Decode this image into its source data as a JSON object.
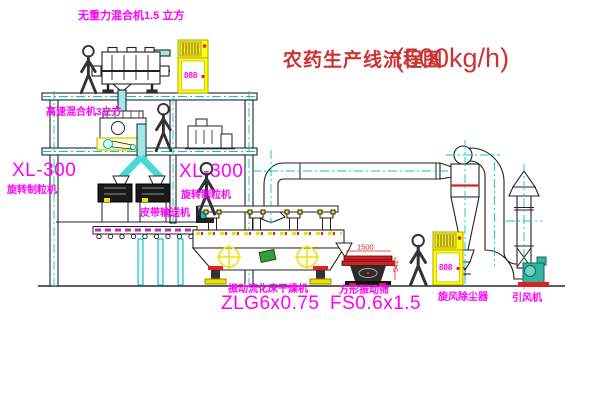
{
  "title": {
    "text": "农药生产线流程图",
    "capacity": "(500kg/h)"
  },
  "labels": {
    "gravity_mixer": "无重力混合机1.5 立方",
    "high_speed_mixer": "高速混合机3立方",
    "granulator_left": {
      "model": "XL-300",
      "name": "旋转制粒机"
    },
    "granulator_right": {
      "model": "XL-300",
      "name": "旋转制粒机"
    },
    "belt_conveyor": "皮带输送机",
    "dryer": {
      "name": "振动流化床干燥机",
      "model": "ZLG6x0.75"
    },
    "sieve": {
      "name": "方形振动筛",
      "model": "FS0.6x1.5"
    },
    "cyclone": "旋风除尘器",
    "fan": "引风机"
  },
  "dimensions": {
    "sieve_length": "1500",
    "sieve_height": "541"
  },
  "control_panel": {
    "display": "888"
  },
  "colors": {
    "label_magenta": "#ff00ff",
    "title_red": "#cc3333",
    "centerline_cyan": "#00c8c8",
    "pipe_cyan_fill": "#9fe8e8",
    "cabinet_yellow": "#ffff00",
    "accent_red": "#e02020",
    "port_yellow": "#f0e000",
    "fan_teal": "#2fb5a0",
    "machine_green": "#3a9a3a"
  }
}
